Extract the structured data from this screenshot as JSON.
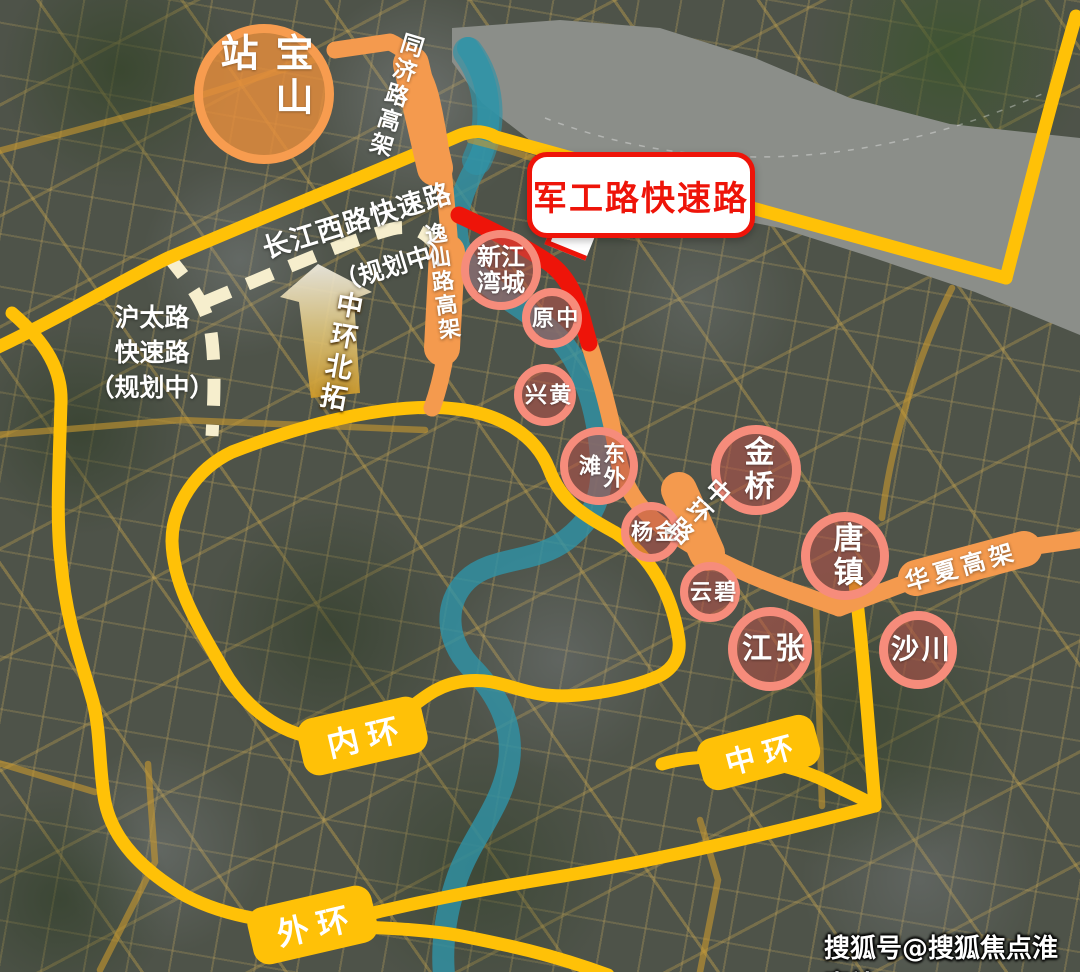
{
  "map": {
    "station": {
      "label": "宝山站"
    },
    "callout": {
      "label": "军工路快速路"
    },
    "arrow": {
      "label": "中环北拓"
    },
    "road_labels": {
      "tongji": "同济路高架",
      "yixian": "逸仙路高架",
      "zhonghuan": "中环路",
      "huaxia": "华夏高架"
    },
    "planned": {
      "changjiang": {
        "line1": "长江西路快速路",
        "line2": "（规划中）"
      },
      "hutai": {
        "lines": "沪太路\n快速路\n（规划中）"
      }
    },
    "ring_badges": [
      {
        "id": "inner",
        "label": "内环"
      },
      {
        "id": "middle",
        "label": "中环"
      },
      {
        "id": "outer",
        "label": "外环"
      }
    ],
    "districts": [
      {
        "id": "xinjiangwancheng",
        "label": "新江\n湾城"
      },
      {
        "id": "zhongyuan",
        "label": "中原"
      },
      {
        "id": "huangxing",
        "label": "黄兴"
      },
      {
        "id": "dongwaitan",
        "label": "东外滩"
      },
      {
        "id": "jinyang",
        "label": "金杨"
      },
      {
        "id": "biyun",
        "label": "碧云"
      },
      {
        "id": "jinqiao",
        "label": "金桥"
      },
      {
        "id": "tangzhen",
        "label": "唐镇"
      },
      {
        "id": "zhangjiang",
        "label": "张江"
      },
      {
        "id": "chuansha",
        "label": "川沙"
      }
    ],
    "watermark": "搜狐号@搜狐焦点淮南站",
    "colors": {
      "ring-yellow": "#ffc107",
      "elevated-orange": "#f49a4e",
      "highlight-red": "#ee1409",
      "planned-cream": "#f6eecd",
      "river-teal": "#2f93a8",
      "water-gray": "#8b8e89",
      "district-fill": "rgba(186,82,72,0.55)",
      "district-border": "#f68c7b",
      "station-fill": "rgba(230,142,60,0.82)",
      "station-border": "#f79c4f",
      "badge-yellow": "#ffc107",
      "callout-red": "#ee1409"
    }
  }
}
